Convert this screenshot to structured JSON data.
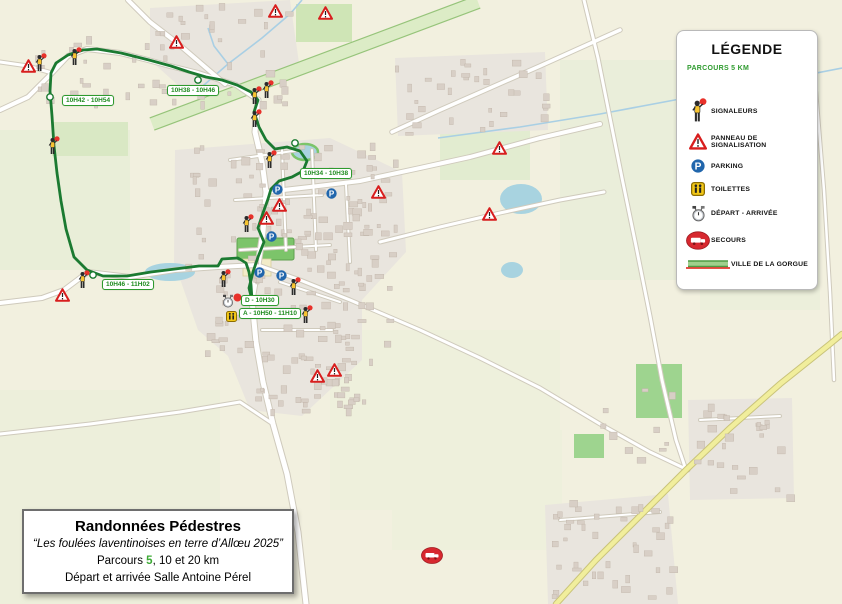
{
  "legend": {
    "title": "LÉGENDE",
    "subtitle": "PARCOURS 5 KM",
    "items": [
      {
        "icon": "signaleur-icon",
        "label": "SIGNALEURS"
      },
      {
        "icon": "warning-triangle-icon",
        "label": "PANNEAU DE SIGNALISATION"
      },
      {
        "icon": "parking-icon",
        "label": "PARKING"
      },
      {
        "icon": "toilets-icon",
        "label": "TOILETTES"
      },
      {
        "icon": "depart-arrivee-icon",
        "label": "DÉPART - ARRIVÉE"
      },
      {
        "icon": "secours-icon",
        "label": "SECOURS"
      },
      {
        "icon": "route-swatch-icon",
        "label": "VILLE DE LA GORGUE"
      }
    ]
  },
  "title_box": {
    "title": "Randonnées Pédestres",
    "subtitle": "“Les foulées laventinoises en terre d’Allœu 2025”",
    "line3_prefix": "Parcours ",
    "line3_highlight": "5",
    "line3_suffix": ", 10 et 20 km",
    "line4": "Départ et arrivée Salle Antoine Pérel",
    "highlight_color": "#3daa35"
  },
  "map": {
    "route_color": "#1b7a31",
    "label_color": "#1e8a1e",
    "route_points": [
      [
        252,
        300
      ],
      [
        249,
        288
      ],
      [
        253,
        272
      ],
      [
        258,
        257
      ],
      [
        264,
        242
      ],
      [
        258,
        228
      ],
      [
        263,
        213
      ],
      [
        268,
        199
      ],
      [
        271,
        189
      ],
      [
        279,
        181
      ],
      [
        292,
        177
      ],
      [
        303,
        171
      ],
      [
        307,
        161
      ],
      [
        300,
        151
      ],
      [
        287,
        147
      ],
      [
        275,
        149
      ],
      [
        266,
        140
      ],
      [
        259,
        127
      ],
      [
        254,
        112
      ],
      [
        258,
        100
      ],
      [
        251,
        92
      ],
      [
        237,
        85
      ],
      [
        222,
        80
      ],
      [
        206,
        77
      ],
      [
        189,
        72
      ],
      [
        171,
        66
      ],
      [
        149,
        60
      ],
      [
        121,
        53
      ],
      [
        97,
        49
      ],
      [
        83,
        50
      ],
      [
        68,
        55
      ],
      [
        56,
        63
      ],
      [
        51,
        73
      ],
      [
        50,
        91
      ],
      [
        52,
        116
      ],
      [
        54,
        146
      ],
      [
        57,
        173
      ],
      [
        61,
        201
      ],
      [
        66,
        229
      ],
      [
        74,
        257
      ],
      [
        87,
        270
      ],
      [
        103,
        276
      ],
      [
        127,
        276
      ],
      [
        151,
        272
      ],
      [
        175,
        269
      ],
      [
        199,
        266
      ],
      [
        218,
        266
      ],
      [
        222,
        259
      ],
      [
        238,
        258
      ],
      [
        246,
        263
      ],
      [
        249,
        272
      ],
      [
        251,
        285
      ],
      [
        252,
        300
      ]
    ],
    "direction_markers": [
      [
        50,
        97
      ],
      [
        198,
        80
      ],
      [
        93,
        275
      ],
      [
        295,
        143
      ]
    ],
    "time_labels": [
      {
        "text": "10H42 - 10H54",
        "x": 62,
        "y": 95
      },
      {
        "text": "10H38 - 10H46",
        "x": 167,
        "y": 85
      },
      {
        "text": "10H34 - 10H38",
        "x": 300,
        "y": 168
      },
      {
        "text": "10H46 - 11H02",
        "x": 102,
        "y": 279
      },
      {
        "text": "D - 10H30",
        "x": 241,
        "y": 295
      },
      {
        "text": "A - 10H50 - 11H10",
        "x": 239,
        "y": 308
      }
    ],
    "markers": {
      "signaleurs": [
        [
          40,
          63
        ],
        [
          75,
          57
        ],
        [
          53,
          146
        ],
        [
          255,
          96
        ],
        [
          267,
          90
        ],
        [
          255,
          119
        ],
        [
          270,
          160
        ],
        [
          247,
          224
        ],
        [
          83,
          280
        ],
        [
          224,
          279
        ],
        [
          294,
          287
        ],
        [
          306,
          315
        ]
      ],
      "panneaux": [
        [
          28,
          66
        ],
        [
          176,
          42
        ],
        [
          275,
          11
        ],
        [
          325,
          13
        ],
        [
          378,
          192
        ],
        [
          279,
          205
        ],
        [
          266,
          218
        ],
        [
          499,
          148
        ],
        [
          489,
          214
        ],
        [
          317,
          376
        ],
        [
          334,
          370
        ],
        [
          62,
          295
        ]
      ],
      "parkings": [
        [
          277,
          189
        ],
        [
          331,
          193
        ],
        [
          271,
          236
        ],
        [
          259,
          272
        ],
        [
          281,
          275
        ]
      ],
      "toilettes": [
        [
          231,
          316
        ]
      ],
      "depart_arrivee": [
        [
          228,
          301
        ]
      ],
      "secours": [
        [
          432,
          555
        ]
      ],
      "start_dot": [
        [
          237,
          297
        ]
      ]
    }
  }
}
